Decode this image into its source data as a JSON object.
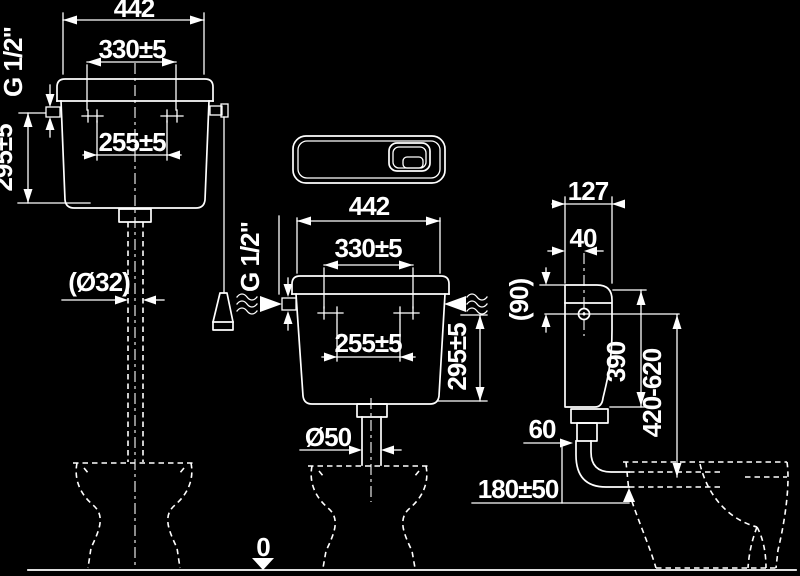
{
  "meta": {
    "background": "#000000",
    "line_color": "#ffffff"
  },
  "datum": {
    "label": "0"
  },
  "high_cistern": {
    "width": "442",
    "mount_outer": "330±5",
    "mount_inner": "255±5",
    "thread": "G 1/2\"",
    "inlet_height": "295±5",
    "pipe_dia": "(Ø32)"
  },
  "low_cistern": {
    "width": "442",
    "mount_outer": "330±5",
    "mount_inner": "255±5",
    "thread": "G 1/2\"",
    "inlet_height": "295±5",
    "outlet_dia": "Ø50",
    "pipe_length": "180±50"
  },
  "side_view": {
    "depth": "127",
    "inlet_offset": "40",
    "lid_to_inlet": "(90)",
    "height": "390",
    "install_height": "420-620",
    "outlet_offset": "60"
  }
}
